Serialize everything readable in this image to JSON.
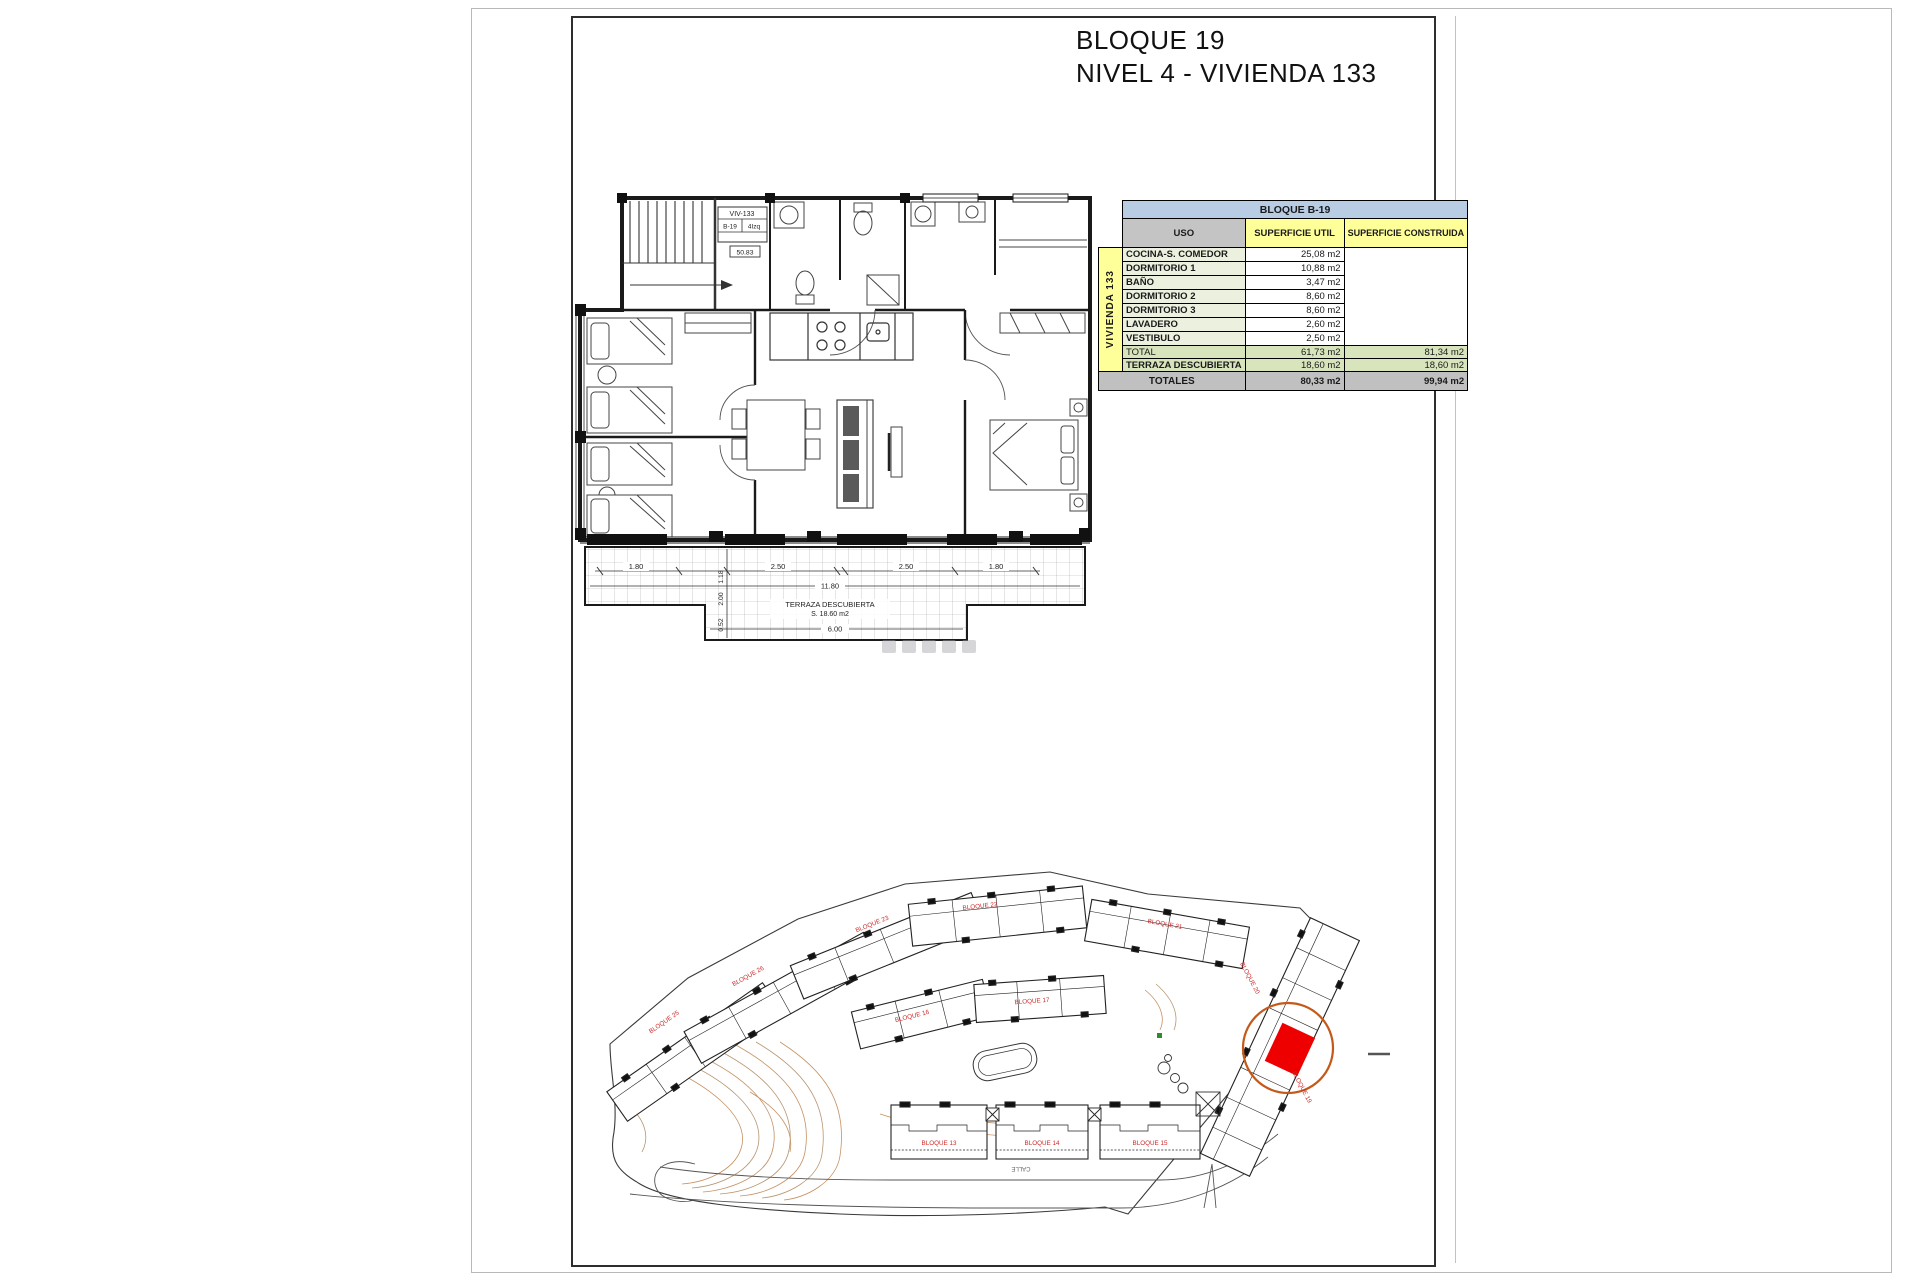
{
  "page": {
    "title_line1": "BLOQUE 19",
    "title_line2": "NIVEL 4 - VIVIENDA 133"
  },
  "plan": {
    "unit_box": {
      "unit": "VIV-133",
      "block": "B-19",
      "position": "4Izq",
      "area_code": "50.83"
    },
    "terrace": {
      "label_line1": "TERRAZA DESCUBIERTA",
      "label_line2": "S. 18.60 m2"
    },
    "dimensions": {
      "top": [
        "1.80",
        "2.50",
        "2.50",
        "1.80"
      ],
      "total_width": "11.80",
      "bottom": "6.00",
      "vertical": [
        "1.18",
        "2.00",
        "0.52"
      ]
    }
  },
  "table": {
    "block_header": "BLOQUE B-19",
    "row_group_label": "VIVIENDA 133",
    "col_headers": {
      "uso": "USO",
      "util": "SUPERFICIE UTIL",
      "construida": "SUPERFICIE CONSTRUIDA"
    },
    "rows": [
      {
        "uso": "COCINA-S. COMEDOR",
        "util": "25,08 m2"
      },
      {
        "uso": "DORMITORIO 1",
        "util": "10,88 m2"
      },
      {
        "uso": "BAÑO",
        "util": "3,47 m2"
      },
      {
        "uso": "DORMITORIO 2",
        "util": "8,60 m2"
      },
      {
        "uso": "DORMITORIO 3",
        "util": "8,60 m2"
      },
      {
        "uso": "LAVADERO",
        "util": "2,60 m2"
      },
      {
        "uso": "VESTIBULO",
        "util": "2,50 m2"
      }
    ],
    "total_row": {
      "label": "TOTAL",
      "util": "61,73 m2",
      "construida": "81,34 m2"
    },
    "terraza_row": {
      "label": "TERRAZA DESCUBIERTA",
      "util": "18,60 m2",
      "construida": "18,60 m2"
    },
    "totales_row": {
      "label": "TOTALES",
      "util": "80,33 m2",
      "construida": "99,94 m2"
    }
  },
  "site_plan": {
    "labels": {
      "b13": "BLOQUE 13",
      "b14": "BLOQUE 14",
      "b15": "BLOQUE 15",
      "b16": "BLOQUE 16",
      "b17": "BLOQUE 17",
      "b19": "BLOQUE 19",
      "b20": "BLOQUE 20",
      "b21": "BLOQUE 21",
      "b22": "BLOQUE 22",
      "b23": "BLOQUE 23",
      "b25": "BLOQUE 25",
      "b26": "BLOQUE 26"
    },
    "street_label": "CALLE",
    "colors": {
      "label_red": "#cc2a2a",
      "highlight_square": "#ee0000",
      "highlight_circle": "#c4591a",
      "contour": "#c08552"
    }
  }
}
